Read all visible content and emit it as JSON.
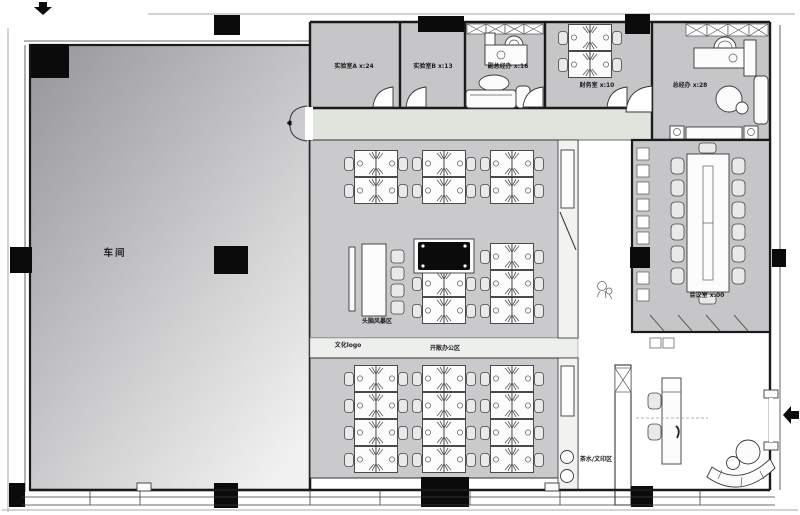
{
  "plan_title": "办公室平面布置图",
  "rooms": {
    "workshop": {
      "label": "车间"
    },
    "lab_a": {
      "label": "实验室A  x:24"
    },
    "lab_b": {
      "label": "实验室B  x:13"
    },
    "vice_gm_office": {
      "label": "副总经办  x:16"
    },
    "finance_room": {
      "label": "财务室  x:10"
    },
    "gm_office": {
      "label": "总经办  x:28"
    },
    "meeting_room": {
      "label": "会议室  x:00"
    }
  },
  "areas": {
    "brainstorm": {
      "label": "头脑风暴区"
    },
    "logo_wall": {
      "label": "文化logo"
    },
    "open_office": {
      "label": "开敞办公区"
    },
    "tea_print": {
      "label": "茶水/文印区"
    }
  },
  "icons": {
    "top_entrance_arrow": "down-arrow",
    "right_entrance_arrow": "left-arrow"
  },
  "colors": {
    "wall": "#1a1a1a",
    "column": "#0b0b0b",
    "room_fill": "#c6c6c8",
    "open_office_fill": "#cacacc",
    "corridor_fill": "#dfe5dc",
    "label_band_fill": "#edefec",
    "workshop_dark": "#96969a",
    "workshop_light": "#f1f1f1",
    "paper": "#ffffff"
  }
}
